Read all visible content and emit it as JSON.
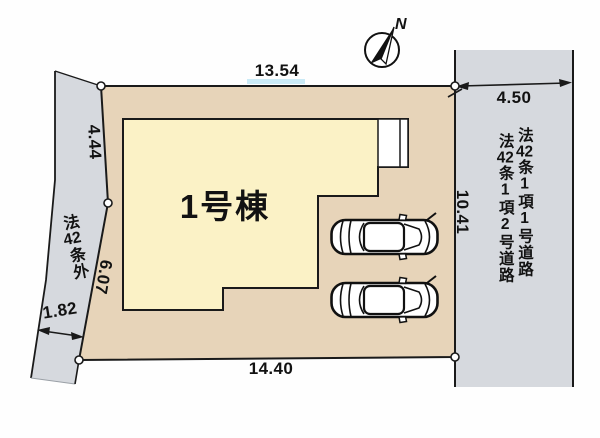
{
  "compass": {
    "north_label": "N"
  },
  "building": {
    "name": "1号棟"
  },
  "dimensions": {
    "top_edge": "13.54",
    "right_road_width": "4.50",
    "left_edge_upper": "4.44",
    "left_edge_lower": "6.07",
    "left_road_width": "1.82",
    "bottom_edge": "14.40",
    "right_edge": "10.41"
  },
  "roads": {
    "left_label_segments": [
      "法",
      "42",
      "条",
      "外"
    ],
    "right_label_primary_segments": [
      "法",
      "42",
      "条",
      "1",
      "項",
      "1",
      "号",
      "道",
      "路"
    ],
    "right_label_secondary_segments": [
      "法",
      "42",
      "条",
      "1",
      "項",
      "2",
      "号",
      "道",
      "路"
    ]
  },
  "colors": {
    "lot_fill": "#e7d4b9",
    "building_fill": "#fbf2c6",
    "road_fill": "#d6d9de",
    "line": "#1a1a1a"
  }
}
